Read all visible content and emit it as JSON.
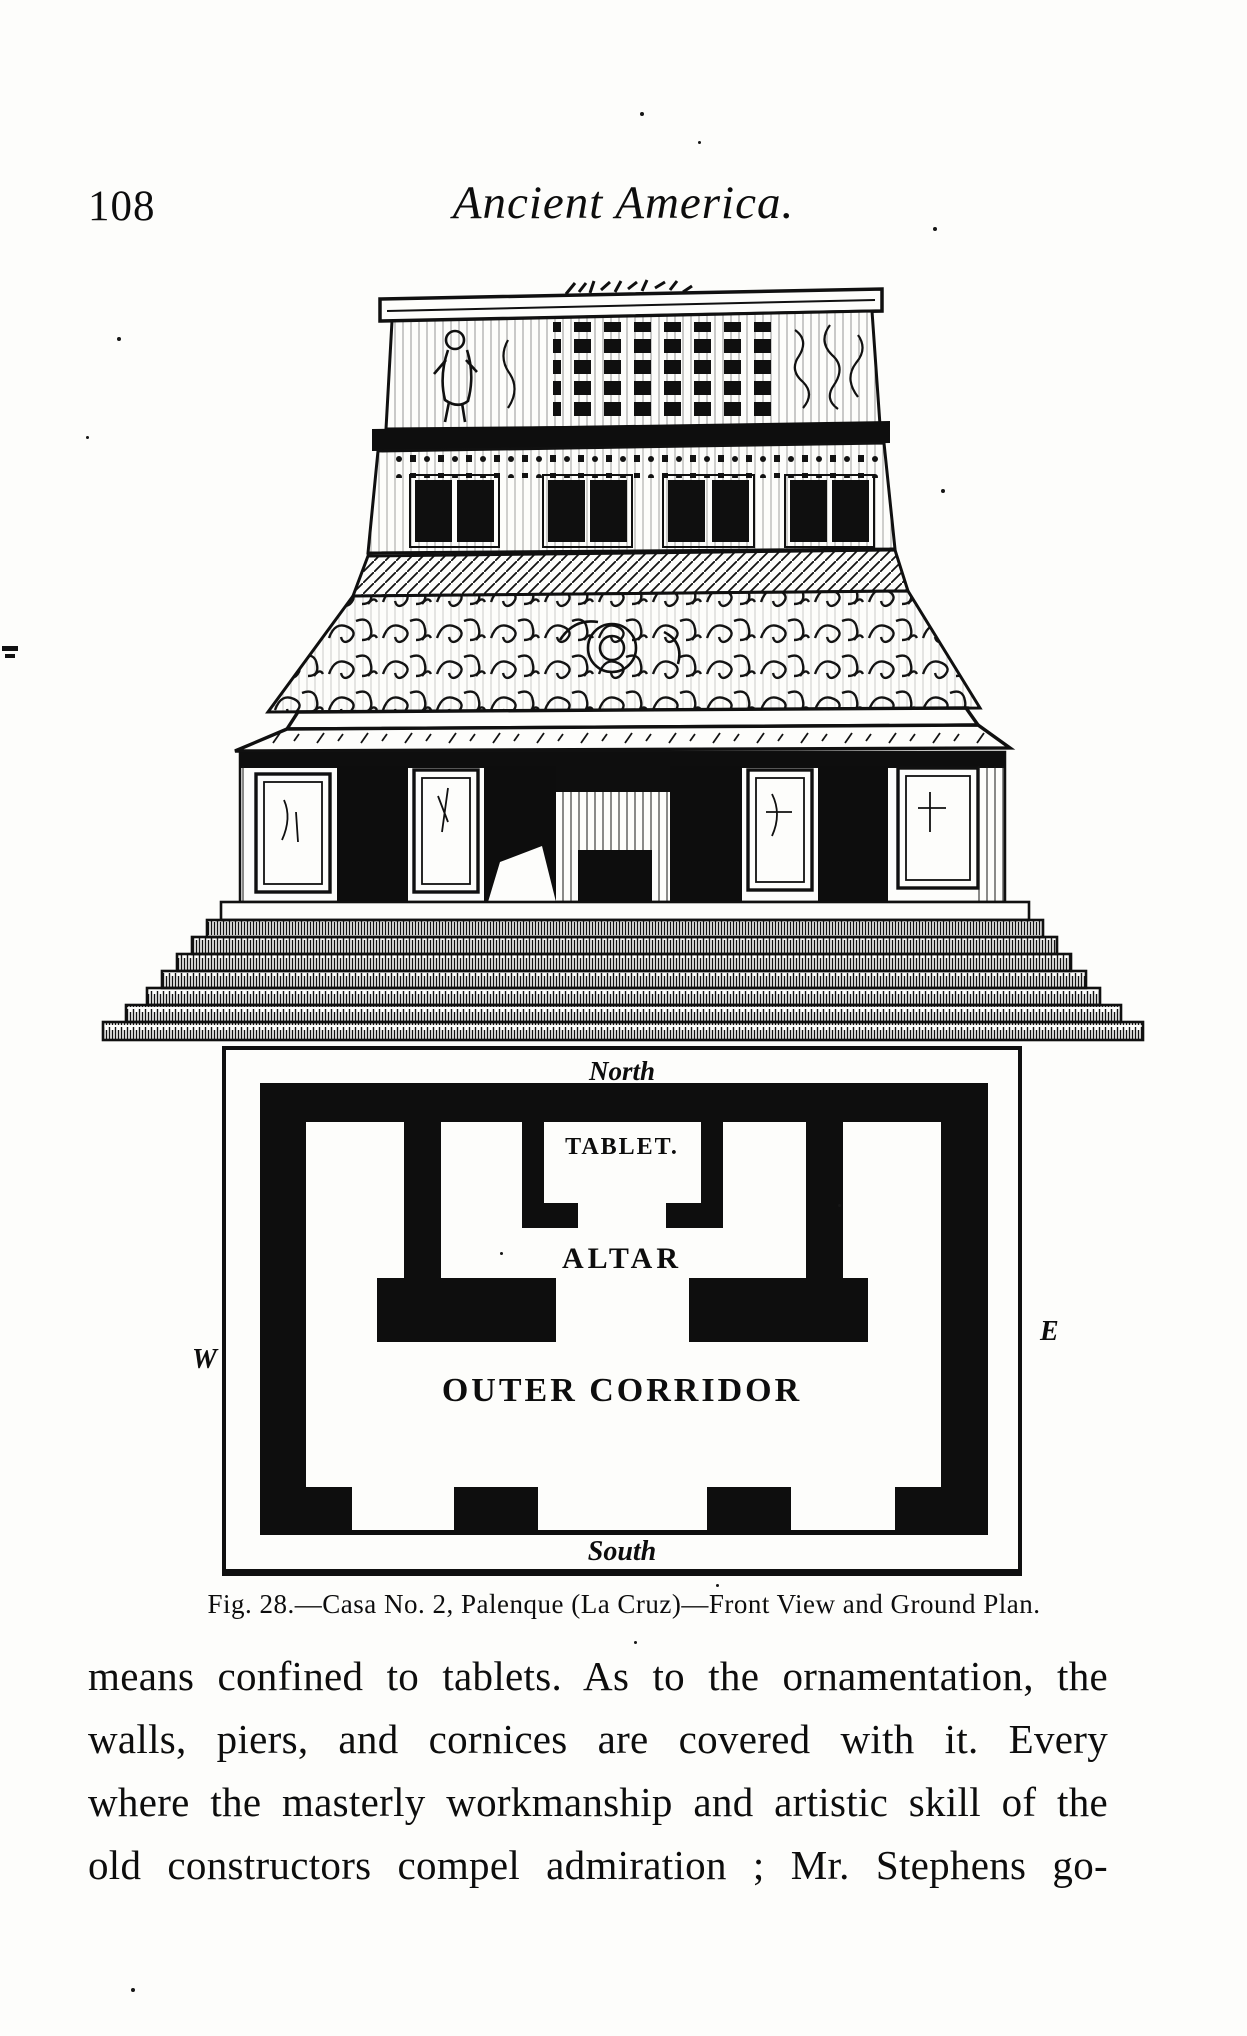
{
  "page": {
    "number": "108",
    "running_title": "Ancient America."
  },
  "figure": {
    "caption": "Fig. 28.—Casa No. 2, Palenque (La Cruz)—Front View and Ground Plan.",
    "subject": "Front elevation engraving of a Maya temple above its ground plan",
    "plan_labels": {
      "north": "North",
      "south": "South",
      "west": "W",
      "east": "E",
      "tablet": "TABLET.",
      "altar": "ALTAR",
      "outer_corridor": "OUTER CORRIDOR"
    }
  },
  "body": {
    "lines": [
      "means confined to tablets.  As to the ornamentation, the",
      "walls, piers, and cornices are covered with it.  Every",
      "where the masterly workmanship and artistic skill of the",
      "old constructors compel admiration ; Mr. Stephens go-"
    ]
  },
  "colors": {
    "ink": "#0d0d0d",
    "paper": "#fdfdfb"
  }
}
